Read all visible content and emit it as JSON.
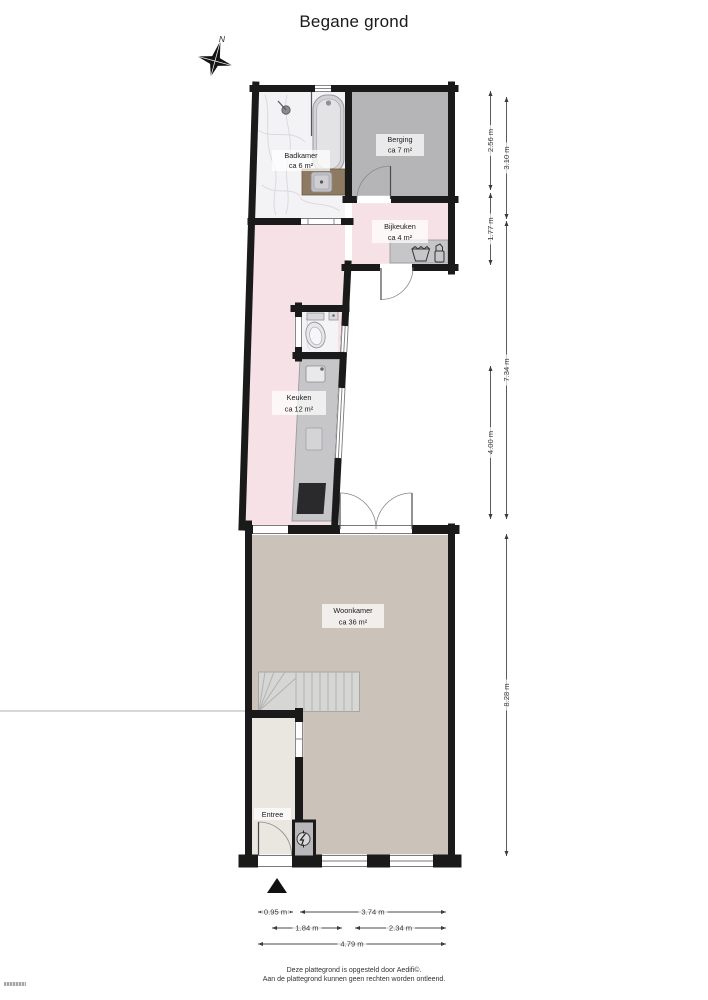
{
  "page": {
    "title": "Begane grond",
    "compass_label": "N"
  },
  "rooms": [
    {
      "name": "Badkamer",
      "area": "ca 6 m²",
      "floor_color": "#f3f2f4"
    },
    {
      "name": "Berging",
      "area": "ca 7 m²",
      "floor_color": "#b5b4b6"
    },
    {
      "name": "Bijkeuken",
      "area": "ca 4 m²",
      "floor_color": "#f6e1e6"
    },
    {
      "name": "Keuken",
      "area": "ca 12 m²",
      "floor_color": "#f6e1e6"
    },
    {
      "name": "Woonkamer",
      "area": "ca 36 m²",
      "floor_color": "#cbc2b9"
    },
    {
      "name": "Entree",
      "floor_color": "#eae6e0"
    }
  ],
  "dimensions": [
    {
      "label": "2.56 m",
      "orientation": "vertical"
    },
    {
      "label": "1.77 m",
      "orientation": "vertical"
    },
    {
      "label": "4.00 m",
      "orientation": "vertical"
    },
    {
      "label": "3.10 m",
      "orientation": "vertical"
    },
    {
      "label": "7.34 m",
      "orientation": "vertical"
    },
    {
      "label": "8.28 m",
      "orientation": "vertical"
    },
    {
      "label": "0.95 m",
      "orientation": "horizontal"
    },
    {
      "label": "3.74 m",
      "orientation": "horizontal"
    },
    {
      "label": "1.84 m",
      "orientation": "horizontal"
    },
    {
      "label": "2.34 m",
      "orientation": "horizontal"
    },
    {
      "label": "4.79 m",
      "orientation": "horizontal"
    }
  ],
  "footer": {
    "line1": "Deze plattegrond is opgesteld door Aedifi©.",
    "line2": "Aan de plattegrond kunnen geen rechten worden ontleend."
  },
  "colors": {
    "wall": "#1a1a1a",
    "dimension_text": "#3a3a3a",
    "counter": "#c6c6c8",
    "stove": "#2a2a2d"
  }
}
